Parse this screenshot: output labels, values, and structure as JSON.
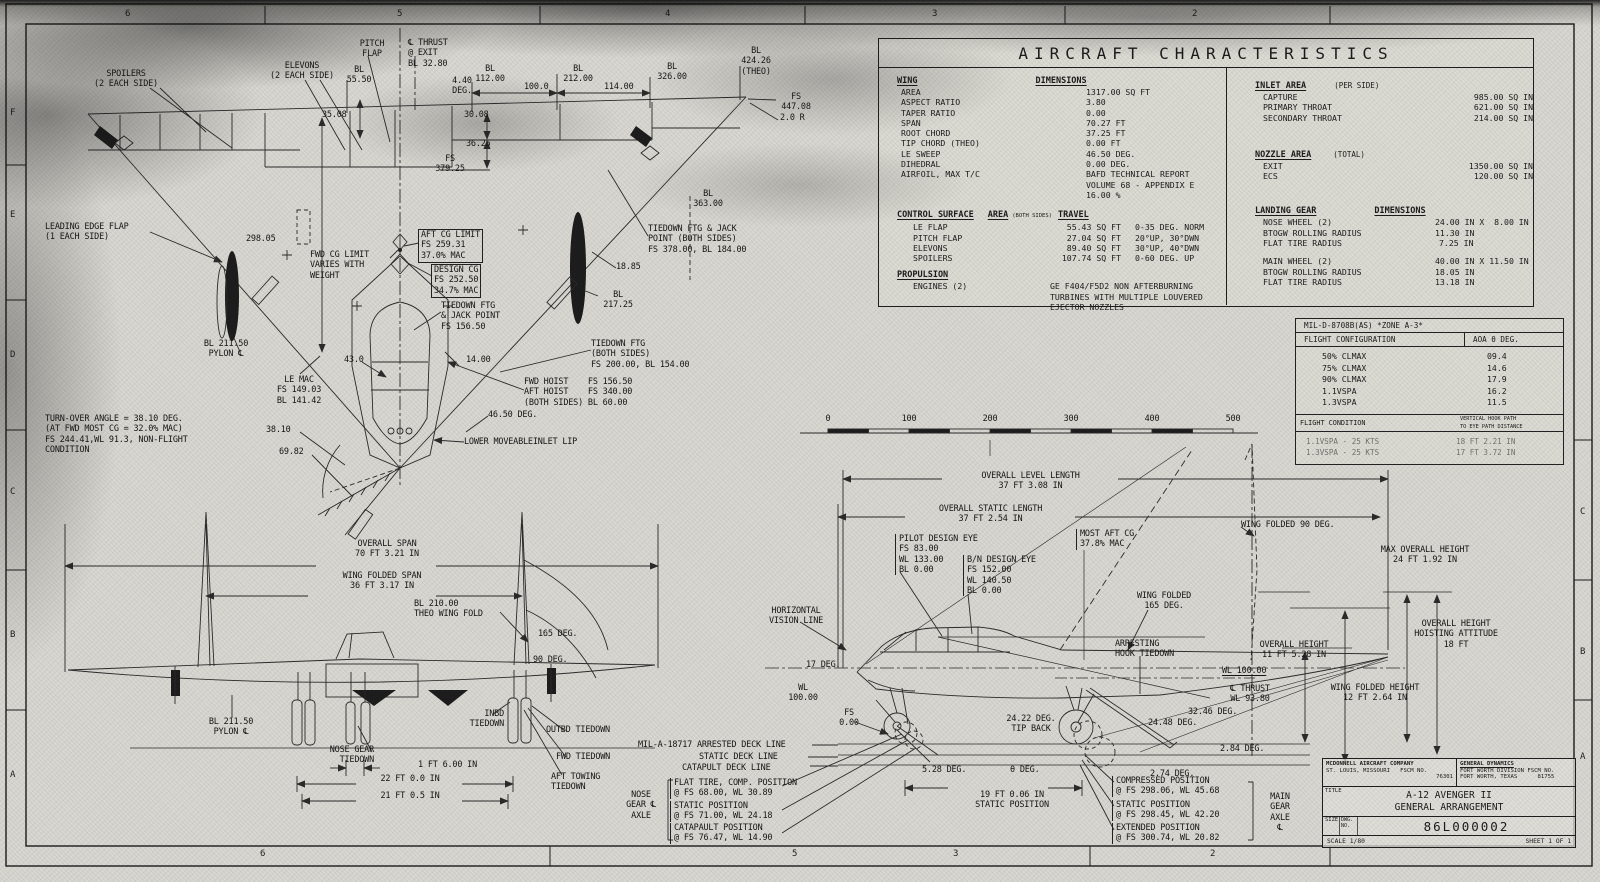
{
  "drawing": {
    "type": "engineering-general-arrangement",
    "aircraft": "A-12 AVENGER II"
  },
  "border_zones": {
    "top": [
      "6",
      "5",
      "4",
      "3",
      "2"
    ],
    "bottom": [
      "6",
      "5",
      "3",
      "2"
    ],
    "left": [
      "F",
      "E",
      "D",
      "C",
      "B",
      "A"
    ],
    "right": [
      "C",
      "B",
      "A"
    ]
  },
  "scale_bar": {
    "ticks": [
      "0",
      "100",
      "200",
      "300",
      "400",
      "500"
    ]
  },
  "char_table": {
    "title": "AIRCRAFT CHARACTERISTICS",
    "wing": {
      "h1": "WING",
      "h2": "DIMENSIONS",
      "rows": [
        {
          "l": "AREA",
          "v": "1317.00 SQ FT"
        },
        {
          "l": "ASPECT RATIO",
          "v": "3.80"
        },
        {
          "l": "TAPER RATIO",
          "v": "0.00"
        },
        {
          "l": "SPAN",
          "v": "70.27 FT"
        },
        {
          "l": "ROOT CHORD",
          "v": "37.25 FT"
        },
        {
          "l": "TIP CHORD (THEO)",
          "v": "0.00 FT"
        },
        {
          "l": "LE SWEEP",
          "v": "46.50 DEG."
        },
        {
          "l": "DIHEDRAL",
          "v": "0.00 DEG."
        },
        {
          "l": "AIRFOIL, MAX T/C",
          "v": "BAFD TECHNICAL REPORT\nVOLUME 68 - APPENDIX E\n16.00 %"
        }
      ]
    },
    "control": {
      "h1": "CONTROL SURFACE",
      "h2": "AREA",
      "h2note": "(BOTH SIDES)",
      "h3": "TRAVEL",
      "rows": [
        {
          "l": "LE FLAP",
          "a": "55.43 SQ FT",
          "t": "0-35 DEG. NORM"
        },
        {
          "l": "PITCH FLAP",
          "a": "27.04 SQ FT",
          "t": "20°UP, 30°DWN"
        },
        {
          "l": "ELEVONS",
          "a": "89.40 SQ FT",
          "t": "30°UP, 40°DWN"
        },
        {
          "l": "SPOILERS",
          "a": "107.74 SQ FT",
          "t": "0-60 DEG. UP"
        }
      ]
    },
    "propulsion": {
      "h1": "PROPULSION",
      "l": "ENGINES (2)",
      "v": "GE F404/F5D2 NON AFTERBURNING\nTURBINES WITH MULTIPLE LOUVERED\nEJECTOR NOZZLES"
    },
    "inlet": {
      "h1": "INLET AREA",
      "note": "(PER SIDE)",
      "rows": [
        {
          "l": "CAPTURE",
          "v": "985.00 SQ IN"
        },
        {
          "l": "PRIMARY THROAT",
          "v": "621.00 SQ IN"
        },
        {
          "l": "SECONDARY THROAT",
          "v": "214.00 SQ IN"
        }
      ]
    },
    "nozzle": {
      "h1": "NOZZLE AREA",
      "note": "(TOTAL)",
      "rows": [
        {
          "l": "EXIT",
          "v": "1350.00 SQ IN"
        },
        {
          "l": "ECS",
          "v": "120.00 SQ IN"
        }
      ]
    },
    "gear": {
      "h1": "LANDING GEAR",
      "h2": "DIMENSIONS",
      "rows": [
        {
          "l": "NOSE WHEEL (2)",
          "v": "24.00 IN X  8.00 IN"
        },
        {
          "l": "BTOGW ROLLING RADIUS",
          "v": "11.30 IN"
        },
        {
          "l": "FLAT TIRE RADIUS",
          "v": "7.25 IN"
        }
      ],
      "rows2": [
        {
          "l": "MAIN WHEEL (2)",
          "v": "40.00 IN X 11.50 IN"
        },
        {
          "l": "BTOGW ROLLING RADIUS",
          "v": "18.05 IN"
        },
        {
          "l": "FLAT TIRE RADIUS",
          "v": "13.18 IN"
        }
      ]
    }
  },
  "mil_table": {
    "header": "MIL-D-8708B(AS)  *ZONE A-3*",
    "col1": "FLIGHT CONFIGURATION",
    "col2": "AOA θ DEG.",
    "rows": [
      {
        "c": "50% CLMAX",
        "v": "09.4"
      },
      {
        "c": "75% CLMAX",
        "v": "14.6"
      },
      {
        "c": "90% CLMAX",
        "v": "17.9"
      },
      {
        "c": "1.1VSPA",
        "v": "16.2"
      },
      {
        "c": "1.3VSPA",
        "v": "11.5"
      }
    ],
    "cond_col1": "FLIGHT CONDITION",
    "cond_col2": "VERTICAL HOOK PATH\nTO EYE PATH DISTANCE",
    "cond_rows": [
      {
        "c": "1.1VSPA - 25 KTS",
        "v": "18 FT 2.21 IN"
      },
      {
        "c": "1.3VSPA - 25 KTS",
        "v": "17 FT 3.72 IN"
      }
    ]
  },
  "plan_view": {
    "labels": [
      "SPOILERS\n(2 EACH SIDE)",
      "ELEVONS\n(2 EACH SIDE)",
      "PITCH\nFLAP",
      "℄ THRUST\n@ EXIT\nBL 32.80",
      "BL\n55.50",
      "4.40\nDEG.",
      "BL\n112.00",
      "100.0",
      "BL\n212.00",
      "114.00",
      "BL\n326.00",
      "BL\n424.26\n(THEO)",
      "FS\n447.08",
      "2.0 R",
      "35.08",
      "30.08",
      "36.25",
      "FS\n379.25",
      "BL\n363.00",
      "LEADING EDGE FLAP\n(1 EACH SIDE)",
      "298.05",
      "FWD CG LIMIT\nVARIES WITH\nWEIGHT",
      "AFT CG LIMIT\nFS 259.31\n37.0% MAC",
      "DESIGN CG\nFS 252.50\n34.7% MAC",
      "TIEDOWN FTG & JACK\nPOINT (BOTH SIDES)\nFS 378.00, BL 184.00",
      "18.85",
      "BL\n217.25",
      "TIEDOWN FTG\n& JACK POINT\nFS 156.50",
      "TIEDOWN FTG\n(BOTH SIDES)\nFS 200.00, BL 154.00",
      "BL 211.50\nPYLON ℄",
      "43.0",
      "14.00",
      "LE MAC\nFS 149.03\nBL 141.42",
      "FWD HOIST    FS 156.50\nAFT HOIST    FS 340.00\n(BOTH SIDES) BL 60.00",
      "46.50 DEG.",
      "TURN-OVER ANGLE = 38.10 DEG.\n(AT FWD MOST CG = 32.0% MAC)\nFS 244.41,WL 91.3, NON-FLIGHT\nCONDITION",
      "38.10",
      "69.82",
      "LOWER MOVEABLEINLET LIP"
    ]
  },
  "front_view": {
    "labels": [
      "OVERALL SPAN\n70 FT 3.21 IN",
      "WING FOLDED SPAN\n36 FT 3.17 IN",
      "BL 210.00\nTHEO WING FOLD",
      "165 DEG.",
      "90 DEG.",
      "BL 211.50\nPYLON ℄",
      "INBD\nTIEDOWN",
      "OUTBD TIEDOWN",
      "NOSE GEAR\nTIEDOWN",
      "1 FT 6.00 IN",
      "FWD TIEDOWN",
      "AFT TOWING\nTIEDOWN",
      "22 FT 0.0 IN",
      "21 FT 0.5 IN"
    ]
  },
  "side_view": {
    "labels": [
      "OVERALL LEVEL LENGTH\n37 FT 3.08 IN",
      "OVERALL STATIC LENGTH\n37 FT 2.54 IN",
      "PILOT DESIGN EYE\nFS 83.00\nWL 133.00\nBL 0.00",
      "B/N DESIGN EYE\nFS 152.00\nWL 140.50\nBL 0.00",
      "MOST AFT CG\n37.8% MAC",
      "WING FOLDED 90 DEG.",
      "WING FOLDED\n165 DEG.",
      "MAX OVERALL HEIGHT\n24 FT 1.92 IN",
      "HORIZONTAL\nVISION LINE",
      "OVERALL HEIGHT\nHOISTING ATTITUDE\n18 FT",
      "ARRESTING\nHOOK TIEDOWN",
      "OVERALL HEIGHT\n11 FT 5.28 IN",
      "17 DEG.",
      "WL\n100.00",
      "WL 100.00",
      "℄ THRUST\nWL 93.80",
      "WING FOLDED HEIGHT\n12 FT 2.64 IN",
      "32.46 DEG.",
      "FS\n0.00",
      "24.22 DEG.\nTIP BACK",
      "24.48 DEG.",
      "2.84 DEG.",
      "MIL-A-18717 ARRESTED DECK LINE",
      "STATIC DECK LINE",
      "CATAPULT DECK LINE",
      "5.28 DEG.",
      "θ DEG.",
      "2.74 DEG.",
      "COMPRESSED POSITION\n@ FS 298.06, WL 45.68",
      "19 FT 0.06 IN\nSTATIC POSITION",
      "STATIC POSITION\n@ FS 298.45, WL 42.20",
      "EXTENDED POSITION\n@ FS 300.74, WL 20.82",
      "MAIN\nGEAR\nAXLE\n℄",
      "NOSE\nGEAR ℄\nAXLE",
      "FLAT TIRE, COMP. POSITION\n@ FS 68.00, WL 30.89",
      "STATIC POSITION\n@ FS 71.00, WL 24.18",
      "CATAPAULT POSITION\n@ FS 76.47, WL 14.90"
    ]
  },
  "title_block": {
    "company_left": {
      "name": "MCDONNELL AIRCRAFT COMPANY",
      "city": "ST. LOUIS, MISSOURI",
      "fscm_label": "FSCM NO.",
      "fscm": "76301"
    },
    "company_right": {
      "name": "GENERAL DYNAMICS",
      "division": "FORT WORTH DIVISION",
      "city": "FORT WORTH, TEXAS",
      "fscm_label": "FSCM NO.",
      "fscm": "81755"
    },
    "title_label": "TITLE",
    "title": "A-12 AVENGER II\nGENERAL ARRANGEMENT",
    "size_label": "SIZE",
    "dwg_label": "DWG.\nNO.",
    "drawing_number": "86L000002",
    "scale": "SCALE  1/80",
    "sheet": "SHEET 1 OF 1"
  }
}
